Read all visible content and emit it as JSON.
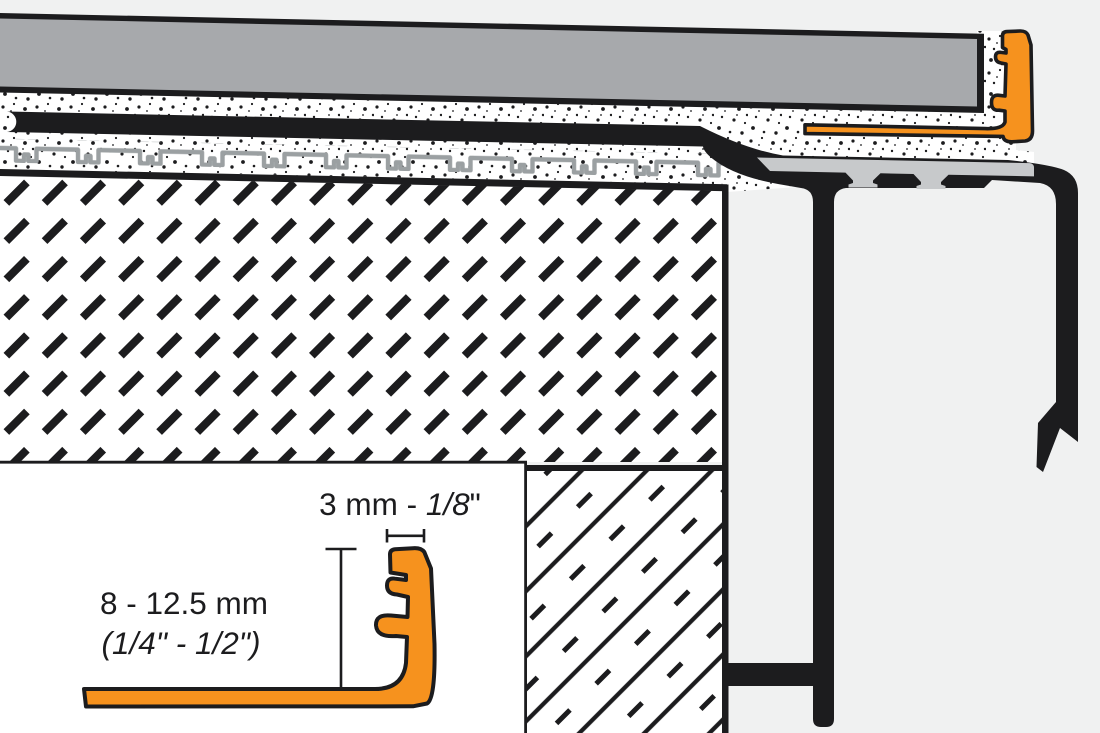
{
  "annotations": {
    "flange_width": {
      "prefix": "3 mm - ",
      "imperial_italic": "1/8",
      "suffix": "\""
    },
    "profile_height": {
      "metric": "8 - 12.5 mm",
      "imperial": "(1/4\" - 1/2\")"
    }
  },
  "colors": {
    "accent_orange": "#F6921E",
    "tile_gray": "#A7A9AC",
    "support_plate_gray": "#C7C9CB",
    "membrane_wave_gray": "#9BA0A2",
    "outline_black": "#1C1C1E",
    "background_gray": "#F0F1F1",
    "paper_white": "#FFFFFF"
  }
}
